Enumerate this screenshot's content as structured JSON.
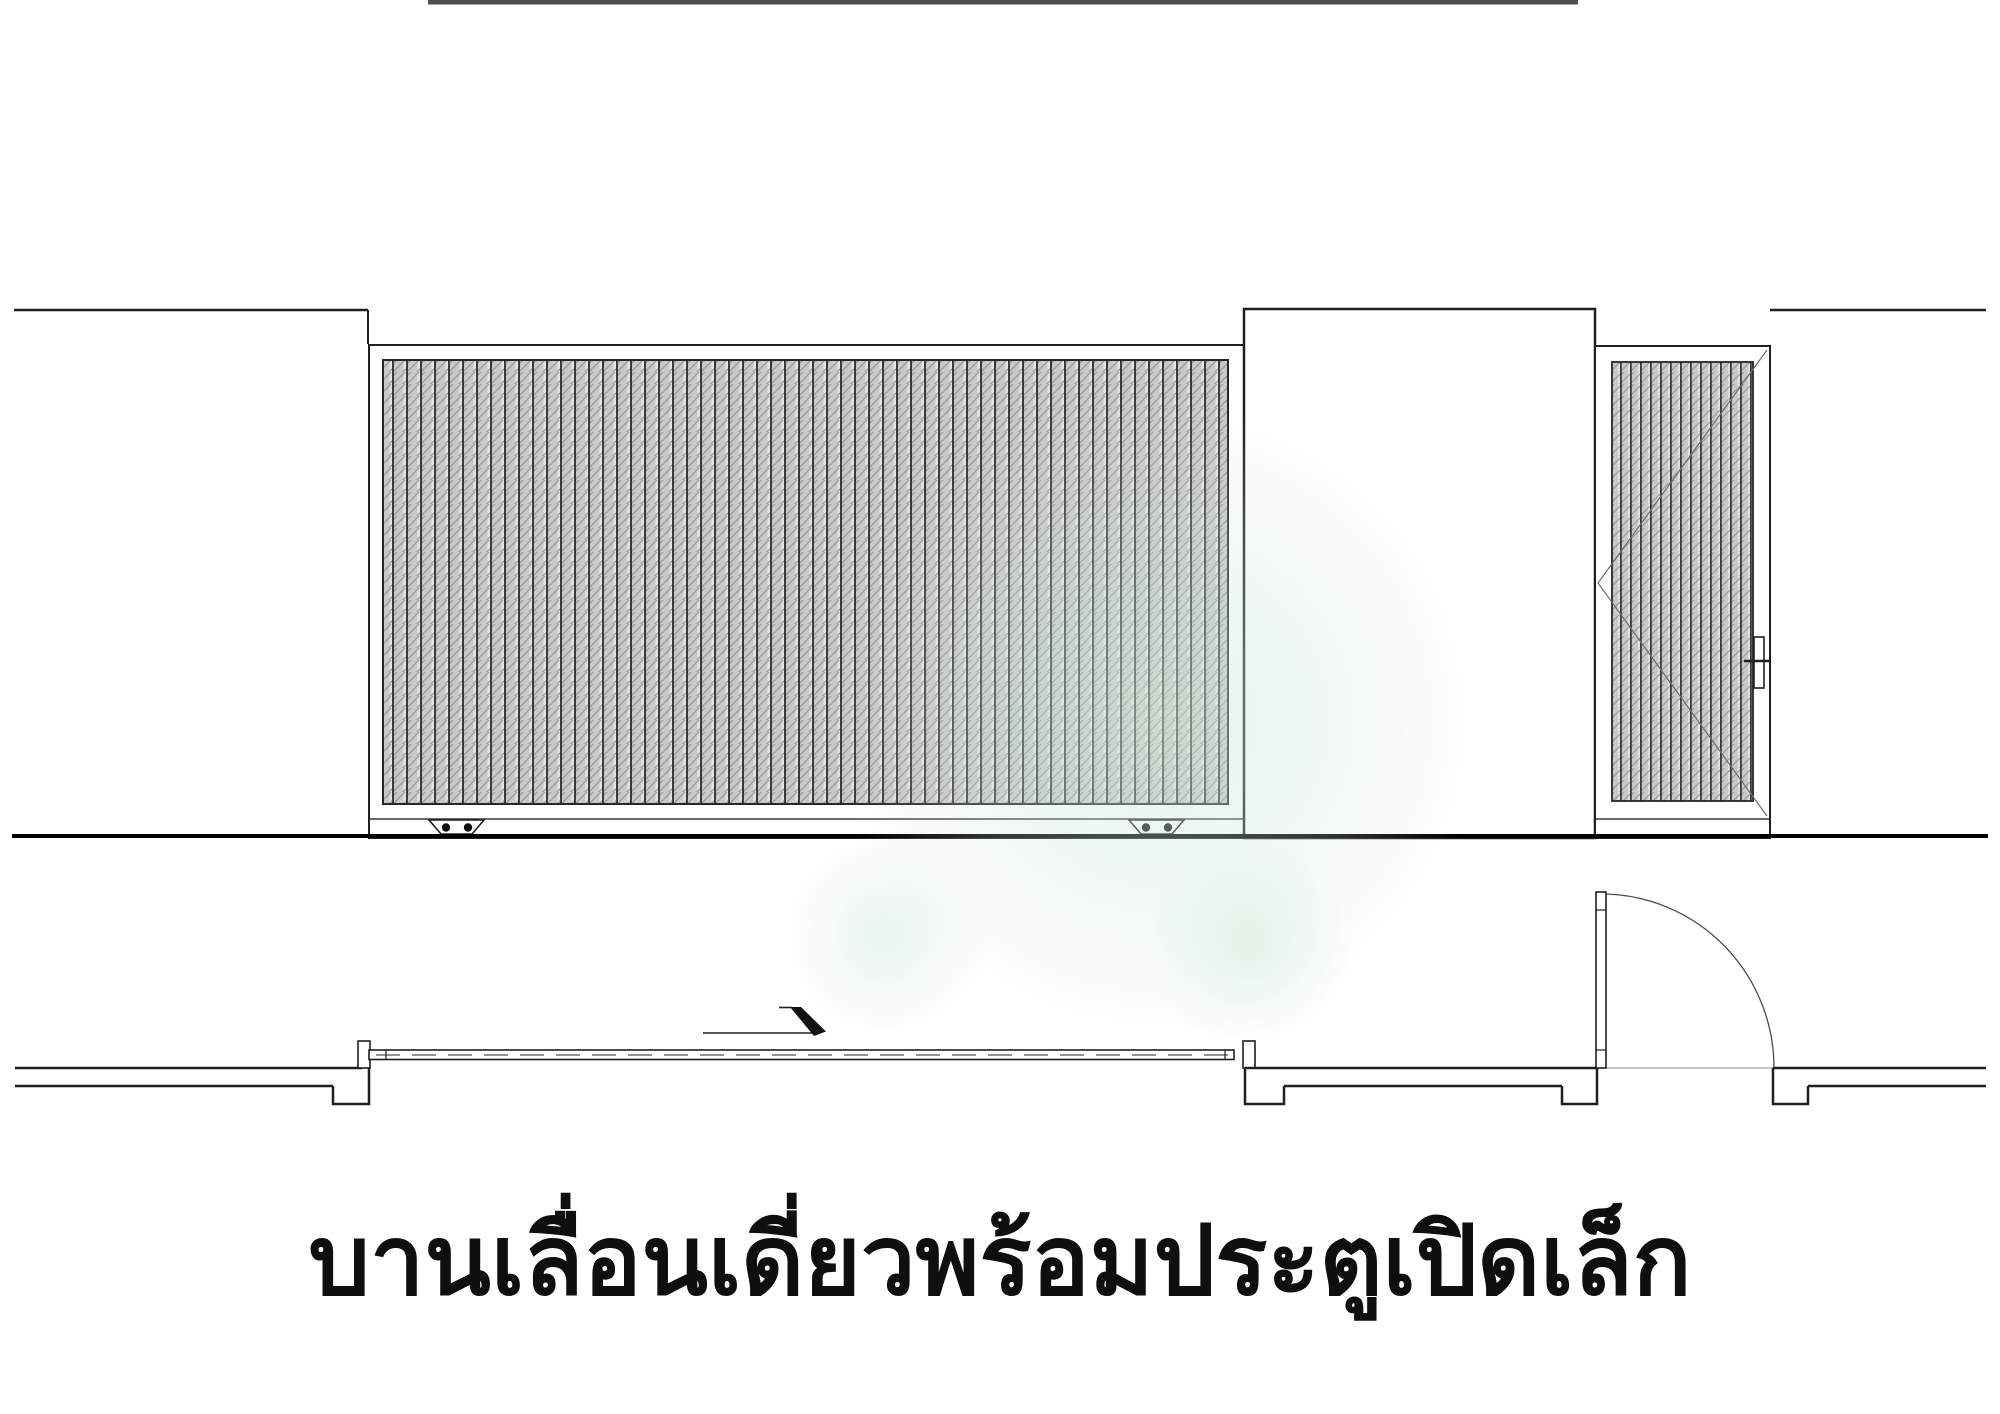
{
  "caption": {
    "text": "บานเลื่อนเดี่ยวพร้อมประตูเปิดเล็ก"
  },
  "drawing": {
    "ink_color": "#1f1f1f",
    "ground_color": "#000000",
    "top_strip_color": "#4f4f4f",
    "hatch_dark_line": "#3a3a3a",
    "hatch_mid_gray": "#c9c9c9",
    "hatch_light_gray": "#e3e3e3",
    "watermark_green": "#cee7d4"
  }
}
